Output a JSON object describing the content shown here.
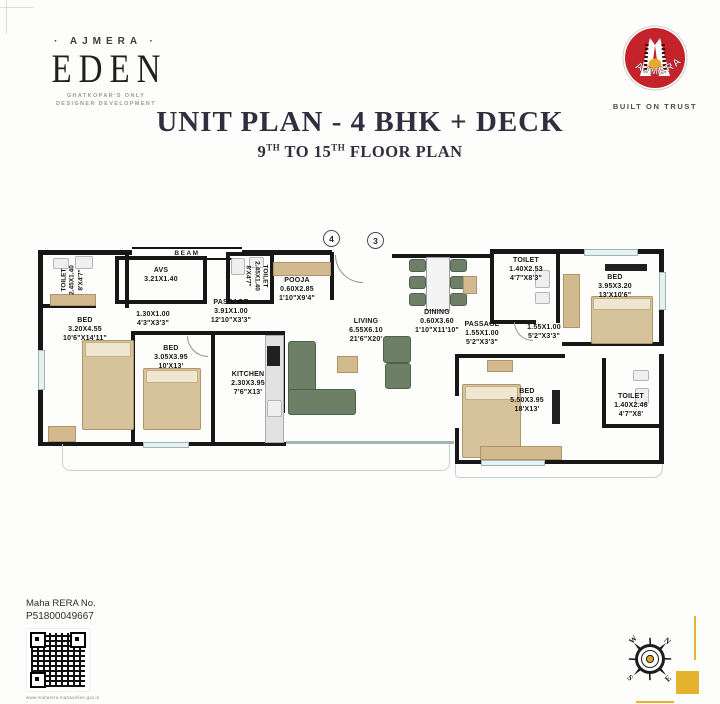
{
  "brand": {
    "name_decorated": "· AJMERA ·",
    "project": "EDEN",
    "tagline_line1": "GHATKOPAR'S ONLY",
    "tagline_line2": "DESIGNER DEVELOPMENT",
    "logo_arc_text": "AJMERA",
    "logo_tagline": "BUILT ON TRUST"
  },
  "header": {
    "title": "UNIT PLAN - 4 BHK + DECK",
    "sub_num1": "9",
    "sub_sup1": "TH",
    "sub_mid": " TO 15",
    "sub_sup2": "TH",
    "sub_tail": " FLOOR PLAN"
  },
  "plan": {
    "beam_label": "BEAM",
    "markers": [
      "4",
      "3"
    ],
    "rooms": {
      "toilet_tl": {
        "lines": [
          "TOILET",
          "2.45X1.40",
          "8'X4'7\""
        ]
      },
      "avs": {
        "lines": [
          "AVS",
          "3.21X1.40"
        ]
      },
      "bed_left": {
        "lines": [
          "BED",
          "3.20X4.55",
          "10'6\"X14'11\""
        ]
      },
      "pass_small": {
        "lines": [
          "1.30X1.00",
          "4'3\"X3'3\""
        ]
      },
      "bed_mid": {
        "lines": [
          "BED",
          "3.05X3.95",
          "10'X13'"
        ]
      },
      "passage": {
        "lines": [
          "PASSAGE",
          "3.91X1.00",
          "12'10\"X3'3\""
        ]
      },
      "toilet_mid": {
        "lines": [
          "TOILET",
          "2.45X1.40",
          "8'X4'7\""
        ]
      },
      "pooja": {
        "lines": [
          "POOJA",
          "0.60X2.85",
          "1'10\"X9'4\""
        ]
      },
      "kitchen": {
        "lines": [
          "KITCHEN",
          "2.30X3.95",
          "7'6\"X13'"
        ]
      },
      "living": {
        "lines": [
          "LIVING",
          "6.55X6.10",
          "21'6\"X20'"
        ]
      },
      "dining": {
        "lines": [
          "DINING",
          "0.60X3.60",
          "1'10\"X11'10\""
        ]
      },
      "passage_r": {
        "lines": [
          "PASSAGE",
          "1.55X1.00",
          "5'2\"X3'3\""
        ]
      },
      "pass_r2": {
        "lines": [
          "1.55X1.00",
          "5'2\"X3'3\""
        ]
      },
      "toilet_tr": {
        "lines": [
          "TOILET",
          "1.40X2.53",
          "4'7\"X8'3\""
        ]
      },
      "bed_tr": {
        "lines": [
          "BED",
          "3.95X3.20",
          "13'X10'6\""
        ]
      },
      "bed_br": {
        "lines": [
          "BED",
          "5.50X3.95",
          "18'X13'"
        ]
      },
      "toilet_br": {
        "lines": [
          "TOILET",
          "1.40X2.46",
          "4'7\"X8'"
        ]
      }
    }
  },
  "footer": {
    "rera_label": "Maha RERA No.",
    "rera_number": "P51800049667",
    "rera_url": "www.maharera.mahaonline.gov.in",
    "compass": {
      "n": "N",
      "e": "E",
      "s": "S",
      "w": "W"
    }
  },
  "colors": {
    "brand_red": "#c4232b",
    "gold": "#e6b32e",
    "title": "#322e3f",
    "wall": "#171717",
    "bed": "#d6c29b",
    "sofa": "#6d7f67"
  }
}
